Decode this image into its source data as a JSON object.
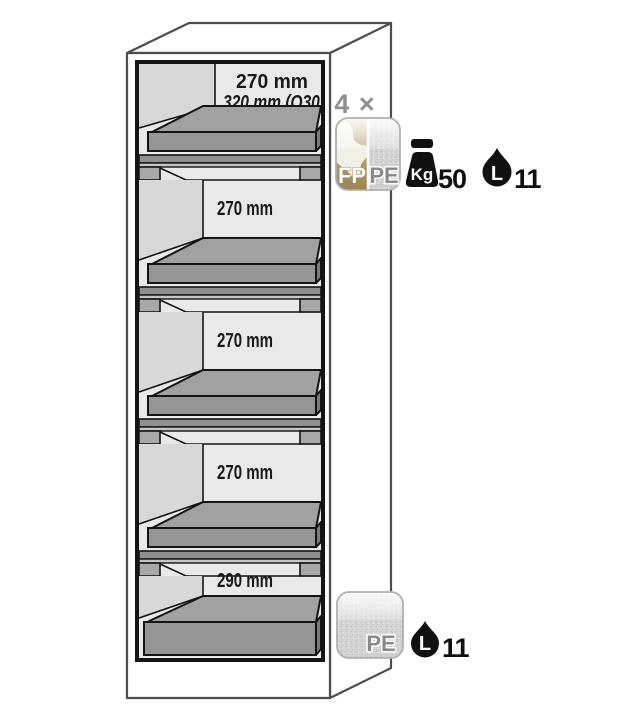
{
  "diagram": {
    "compartments": [
      {
        "line1": "270 mm",
        "line2": "320 mm (Q30)"
      },
      {
        "line1": "270 mm"
      },
      {
        "line1": "270 mm"
      },
      {
        "line1": "270 mm"
      },
      {
        "line1": "290 mm"
      }
    ]
  },
  "callouts": {
    "top": {
      "quantity": "4 ×",
      "badge": {
        "left": "FP",
        "right": "PE"
      },
      "load": {
        "unit": "Kg",
        "value": "50"
      },
      "volume": {
        "unit": "L",
        "value": "11"
      }
    },
    "bottom": {
      "badge": {
        "label": "PE"
      },
      "volume": {
        "unit": "L",
        "value": "11"
      }
    }
  },
  "icons": {
    "top": [
      "fp-pe-tray-badge",
      "kg-weight-icon",
      "liquid-drop-icon"
    ],
    "bottom": [
      "pe-tray-badge",
      "liquid-drop-icon"
    ]
  },
  "colors": {
    "cabinet_outline": "#4d4d4d",
    "interior_line": "#141414",
    "compartment_bg": "#e9e9e9",
    "side_wall": "#d8d8d8",
    "tray_gray": "#a1a1a1",
    "fp_tan": "#a28a55",
    "badge_speckle_gray": "#d2d2d2",
    "label_gray": "#8a8a8a",
    "icon_black": "#111111"
  }
}
